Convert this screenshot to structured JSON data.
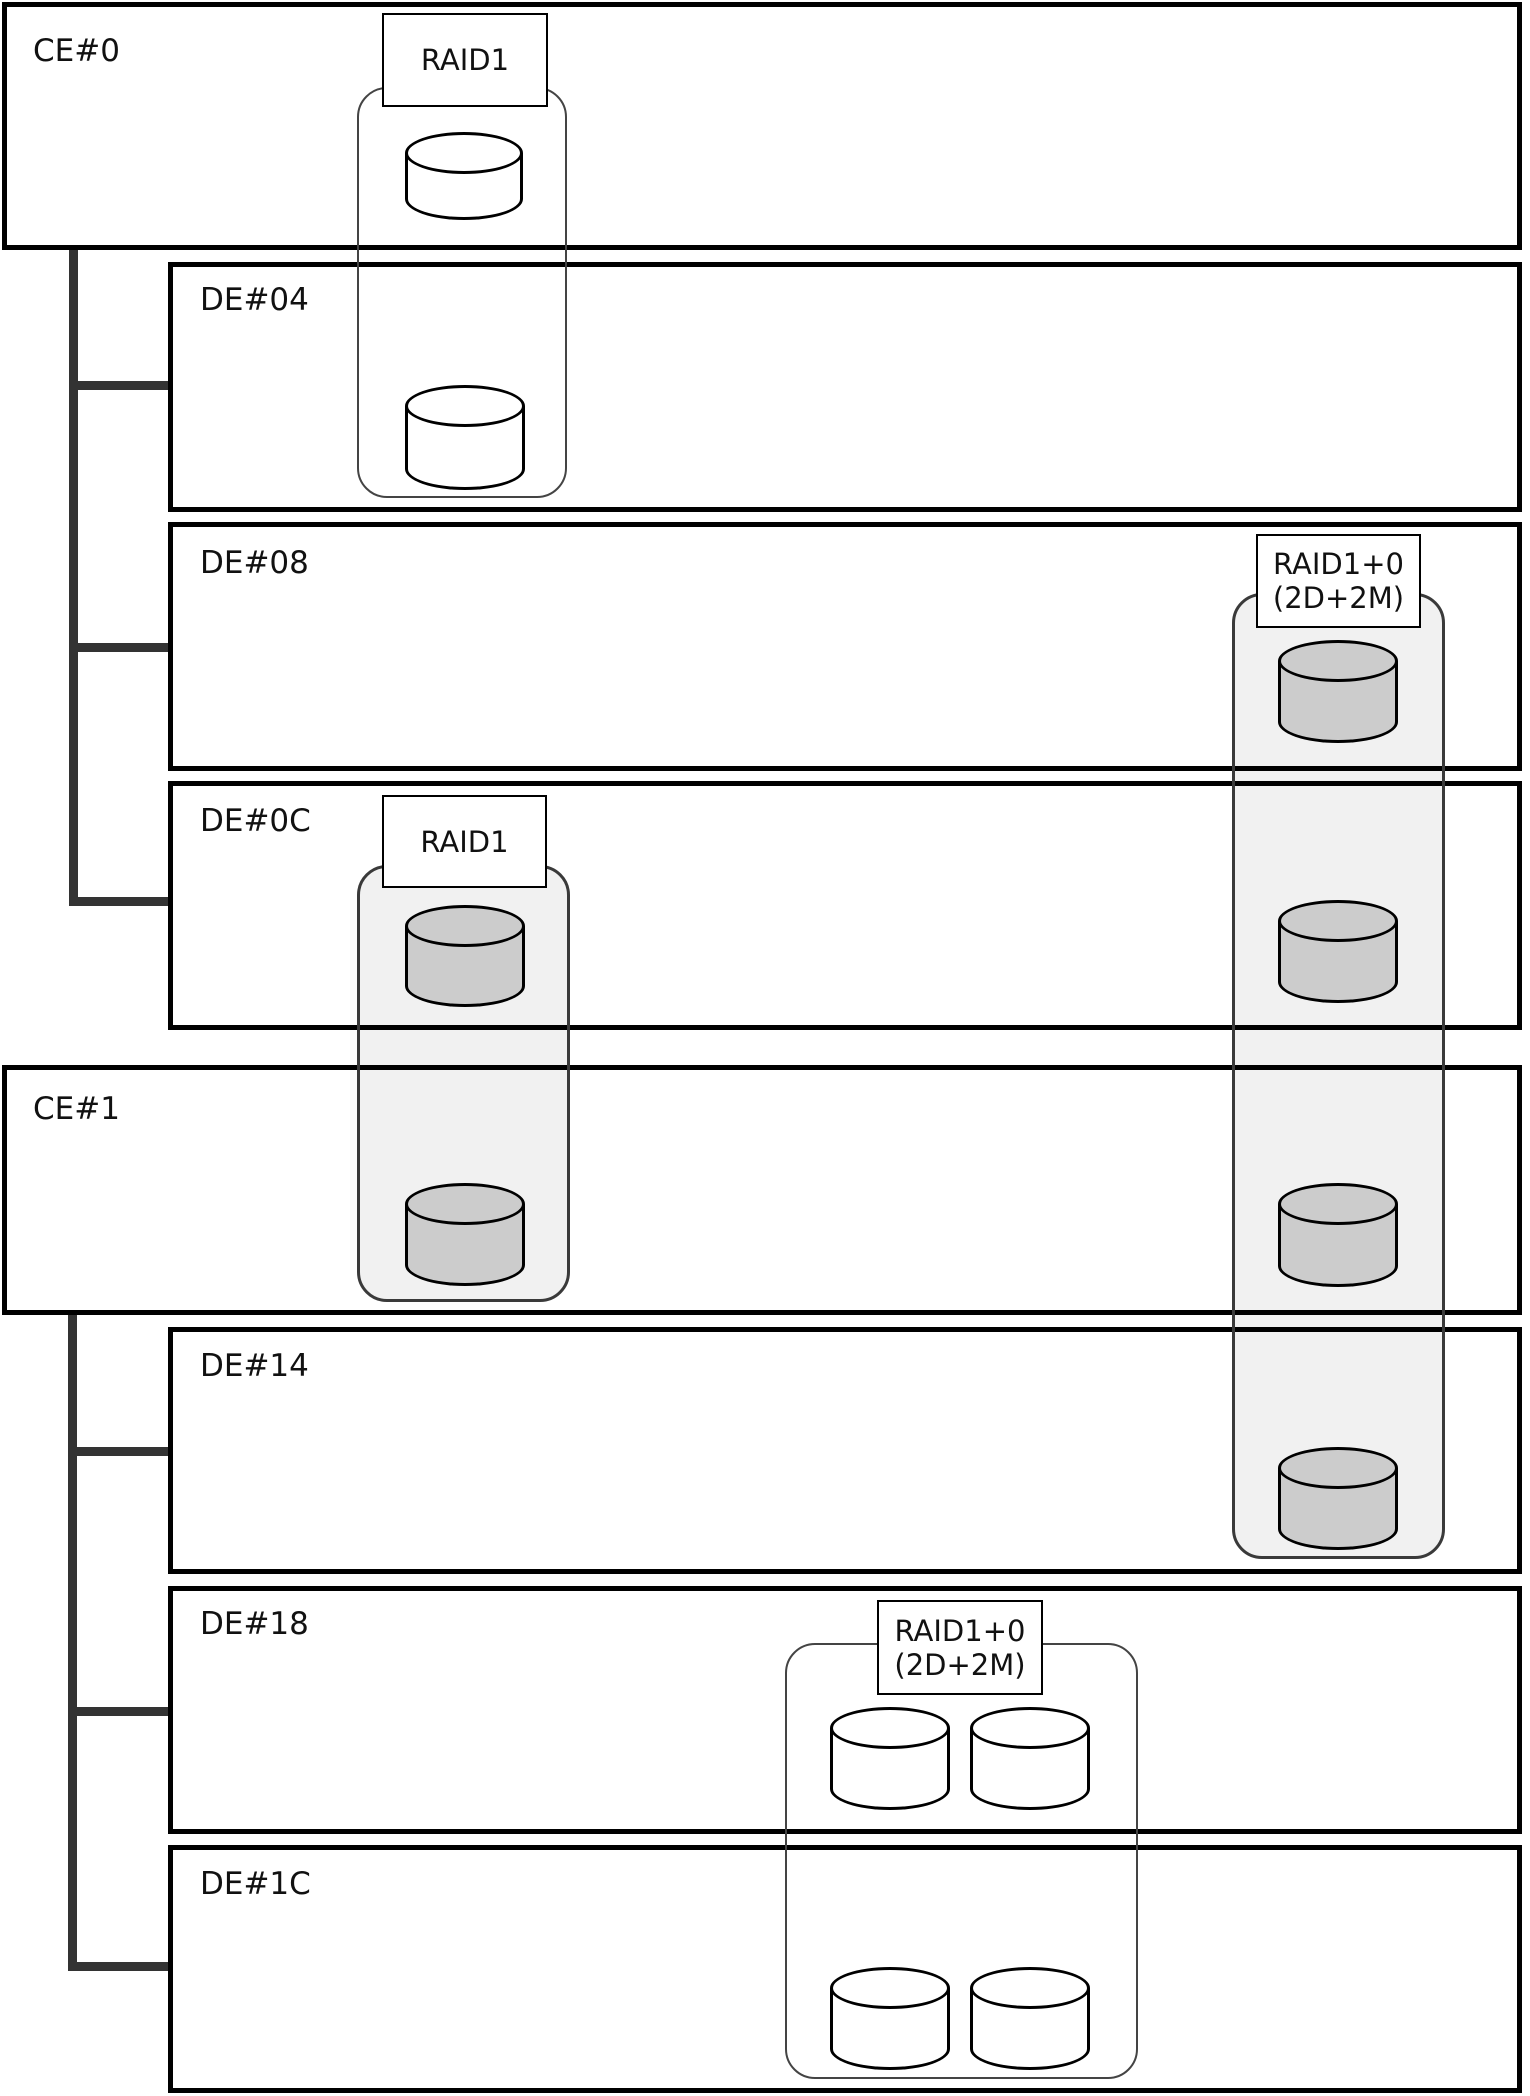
{
  "diagram": {
    "canvas": {
      "width": 1530,
      "height": 2096,
      "background": "#ffffff"
    },
    "colors": {
      "box_border": "#000000",
      "shaded_fill": "#f1f1f1",
      "shaded_border": "#3a3a3a",
      "plain_fill": "#ffffff",
      "plain_border": "#444444",
      "disk_shaded": "#cccccc",
      "disk_plain": "#ffffff",
      "disk_border": "#000000",
      "connector": "#333333",
      "label_bg": "#ffffff",
      "label_border": "#000000",
      "text": "#111111"
    },
    "enclosures": [
      {
        "id": "ce0",
        "label": "CE#0",
        "x": 2,
        "y": 2,
        "w": 1520,
        "h": 248,
        "lx": 33,
        "ly": 36
      },
      {
        "id": "de04",
        "label": "DE#04",
        "x": 168,
        "y": 262,
        "w": 1354,
        "h": 250,
        "lx": 200,
        "ly": 285
      },
      {
        "id": "de08",
        "label": "DE#08",
        "x": 168,
        "y": 522,
        "w": 1354,
        "h": 249,
        "lx": 200,
        "ly": 548
      },
      {
        "id": "de0c",
        "label": "DE#0C",
        "x": 168,
        "y": 781,
        "w": 1354,
        "h": 249,
        "lx": 200,
        "ly": 806
      },
      {
        "id": "ce1",
        "label": "CE#1",
        "x": 2,
        "y": 1065,
        "w": 1520,
        "h": 250,
        "lx": 33,
        "ly": 1094
      },
      {
        "id": "de14",
        "label": "DE#14",
        "x": 168,
        "y": 1327,
        "w": 1354,
        "h": 247,
        "lx": 200,
        "ly": 1351
      },
      {
        "id": "de18",
        "label": "DE#18",
        "x": 168,
        "y": 1586,
        "w": 1354,
        "h": 248,
        "lx": 200,
        "ly": 1609
      },
      {
        "id": "de1c",
        "label": "DE#1C",
        "x": 168,
        "y": 1845,
        "w": 1354,
        "h": 248,
        "lx": 200,
        "ly": 1869
      }
    ],
    "connectors": [
      {
        "id": "trunk-ce0",
        "type": "trunk",
        "x": 69,
        "y": 250,
        "w": 9,
        "h": 656
      },
      {
        "id": "stub-de04",
        "type": "stub",
        "x": 69,
        "y": 381,
        "w": 99,
        "h": 9
      },
      {
        "id": "stub-de08",
        "type": "stub",
        "x": 69,
        "y": 643,
        "w": 99,
        "h": 9
      },
      {
        "id": "stub-de0c",
        "type": "stub",
        "x": 69,
        "y": 897,
        "w": 99,
        "h": 9
      },
      {
        "id": "trunk-ce1",
        "type": "trunk",
        "x": 68,
        "y": 1315,
        "w": 9,
        "h": 656
      },
      {
        "id": "stub-de14",
        "type": "stub",
        "x": 68,
        "y": 1447,
        "w": 100,
        "h": 9
      },
      {
        "id": "stub-de18",
        "type": "stub",
        "x": 68,
        "y": 1707,
        "w": 100,
        "h": 9
      },
      {
        "id": "stub-de1c",
        "type": "stub",
        "x": 68,
        "y": 1962,
        "w": 100,
        "h": 9
      }
    ],
    "raid_groups": [
      {
        "id": "rg1",
        "label": "RAID1",
        "style": "plain",
        "rect": {
          "x": 357,
          "y": 87,
          "w": 210,
          "h": 411
        },
        "label_box": {
          "x": 382,
          "y": 13,
          "w": 166,
          "h": 94
        },
        "disks": [
          {
            "x": 405,
            "y": 132,
            "w": 118,
            "h": 88,
            "in": "CE#0"
          },
          {
            "x": 405,
            "y": 385,
            "w": 120,
            "h": 105,
            "in": "DE#04"
          }
        ]
      },
      {
        "id": "rg2",
        "label": "RAID1",
        "style": "shaded",
        "rect": {
          "x": 357,
          "y": 865,
          "w": 213,
          "h": 437
        },
        "label_box": {
          "x": 382,
          "y": 795,
          "w": 165,
          "h": 93
        },
        "disks": [
          {
            "x": 405,
            "y": 905,
            "w": 120,
            "h": 102,
            "in": "DE#0C"
          },
          {
            "x": 405,
            "y": 1183,
            "w": 120,
            "h": 103,
            "in": "CE#1"
          }
        ]
      },
      {
        "id": "rg3",
        "label": "RAID1+0\n(2D+2M)",
        "style": "shaded",
        "rect": {
          "x": 1232,
          "y": 593,
          "w": 213,
          "h": 966
        },
        "label_box": {
          "x": 1256,
          "y": 534,
          "w": 165,
          "h": 94
        },
        "disks": [
          {
            "x": 1278,
            "y": 640,
            "w": 120,
            "h": 103,
            "in": "DE#08"
          },
          {
            "x": 1278,
            "y": 900,
            "w": 120,
            "h": 103,
            "in": "DE#0C"
          },
          {
            "x": 1278,
            "y": 1183,
            "w": 120,
            "h": 104,
            "in": "CE#1"
          },
          {
            "x": 1278,
            "y": 1447,
            "w": 120,
            "h": 103,
            "in": "DE#14"
          }
        ]
      },
      {
        "id": "rg4",
        "label": "RAID1+0\n(2D+2M)",
        "style": "plain",
        "rect": {
          "x": 785,
          "y": 1643,
          "w": 353,
          "h": 436
        },
        "label_box": {
          "x": 877,
          "y": 1600,
          "w": 166,
          "h": 95
        },
        "disks": [
          {
            "x": 830,
            "y": 1707,
            "w": 120,
            "h": 103,
            "in": "DE#18"
          },
          {
            "x": 970,
            "y": 1707,
            "w": 120,
            "h": 103,
            "in": "DE#18"
          },
          {
            "x": 830,
            "y": 1967,
            "w": 120,
            "h": 103,
            "in": "DE#1C"
          },
          {
            "x": 970,
            "y": 1967,
            "w": 120,
            "h": 103,
            "in": "DE#1C"
          }
        ]
      }
    ]
  }
}
